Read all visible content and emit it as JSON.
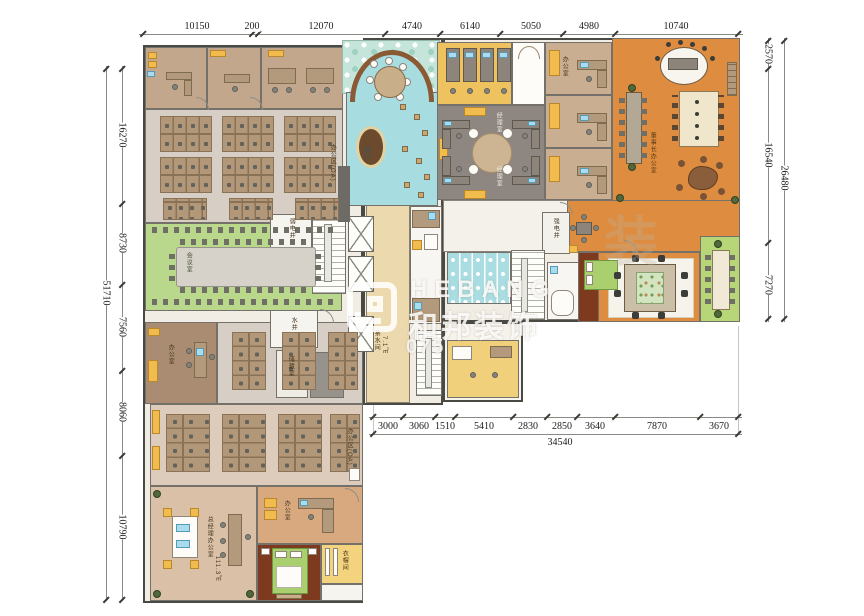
{
  "watermark": {
    "brand": "HEBANG",
    "brand_cn": "和邦装饰",
    "phone_fragment": "075",
    "ghost_char": "装"
  },
  "dims": {
    "top": [
      "10150",
      "200",
      "12070",
      "4740",
      "6140",
      "5050",
      "4980",
      "10740"
    ],
    "left": [
      "16270",
      "8730",
      "7560",
      "8060",
      "10790"
    ],
    "left_total": "51710",
    "right": [
      "2570",
      "16540",
      "7270"
    ],
    "right_total": "26480",
    "bottom": [
      "3000",
      "3060",
      "1510",
      "5410",
      "2830",
      "2850",
      "3640",
      "7870",
      "3670"
    ],
    "bottom_total": "34540"
  },
  "labels": {
    "weak_shaft": "弱电井",
    "water_shaft": "水井",
    "strong_shaft": "强电井",
    "conference": "会议室",
    "open_office": "办公区(OA)",
    "gm_office": "总经理办公室",
    "gm_area": "111.3㎡",
    "manager": "经理室",
    "chairman": "董事长办公室",
    "pantry": "茶水间",
    "pantry_area": "7.1㎡",
    "storage": "储藏室",
    "cloak": "衣帽间",
    "office": "办公室",
    "lobby": "前厅"
  }
}
